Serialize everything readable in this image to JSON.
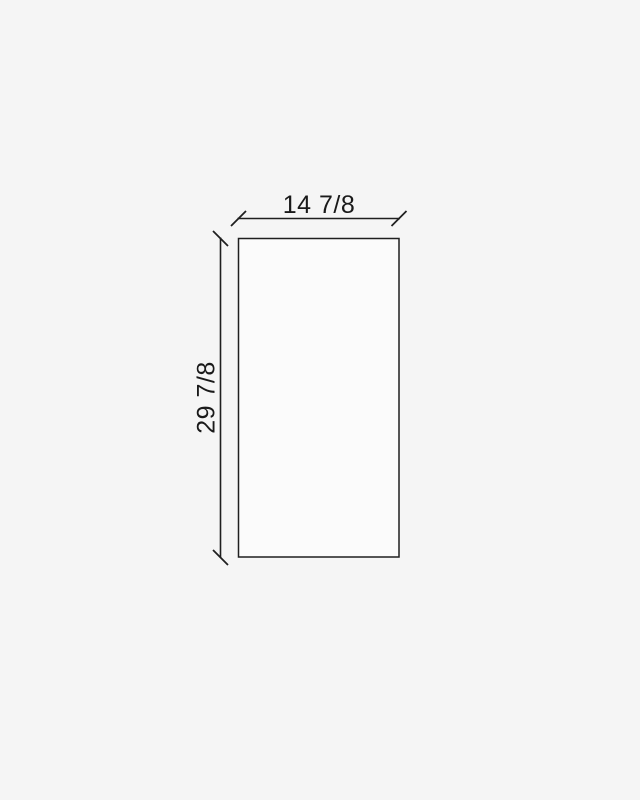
{
  "page": {
    "background": "#f5f5f5"
  },
  "drawing": {
    "panel": {
      "fill": "#fbfbfb",
      "stroke": "#1f1f1f"
    },
    "line_color": "#1f1f1f",
    "text_color": "#1a1a1a",
    "dimensions": {
      "width": {
        "label": "14 7/8",
        "value": 14.875
      },
      "height": {
        "label": "29 7/8",
        "value": 29.875
      }
    }
  }
}
